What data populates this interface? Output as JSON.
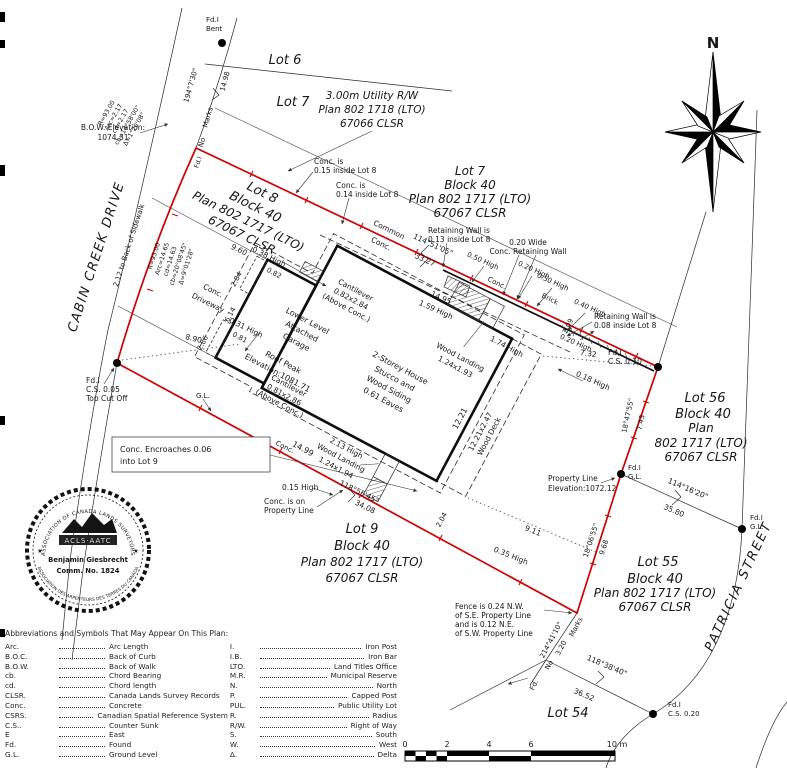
{
  "colors": {
    "boundary": "#d10000",
    "ink": "#161616"
  },
  "compass": {
    "north": "N"
  },
  "labels": {
    "fdi_bent_1": "Fd.I",
    "fdi_bent_2": "Bent",
    "lot6": "Lot 6",
    "lot7_nw": "Lot 7",
    "utility_rw_1": "3.00m Utility R/W",
    "utility_rw_2": "Plan 802 1718 (LTO)",
    "utility_rw_3": "67066 CLSR",
    "brg_street_n": "194°7'30\"",
    "dist_street_n": "14.98",
    "marks_top": "Marks",
    "no_top": "No",
    "fdi_p1": "Fd.I",
    "curve1_r": "R=93.00",
    "curve1_arc": "Arc=2.17",
    "curve1_cd": "cd=2.17",
    "curve1_cb": "cb=14°58'00\"",
    "curve1_d": "Δ=1°20'08\"",
    "bow_1": "B.O.W. Elevation:",
    "bow_2": "1074.31",
    "cabin_creek": "CABIN CREEK DRIVE",
    "sidewalk_tie": "2.12 to Back of Sidewalk",
    "curve2_r": "R=93.00",
    "curve2_arc": "Arc=14.65",
    "curve2_cd": "cd=14.63",
    "curve2_cb": "cb=20°08'45\"",
    "curve2_d": "Δ=9°01'28\"",
    "lot8_1": "Lot 8",
    "lot8_2": "Block 40",
    "lot8_3": "Plan 802 1717 (LTO)",
    "lot8_4": "67067 CLSR",
    "conc015_1": "Conc. is",
    "conc015_2": "0.15 inside Lot 8",
    "conc014_1": "Conc. is",
    "conc014_2": "0.14 inside Lot 8",
    "common_1": "Common",
    "common_2": "Conc.",
    "brg_north": "114°51'05\"",
    "dist_north": "33.27",
    "dim_960": "9.60",
    "h_038": "0.38 High",
    "conc_drive_1": "Conc.",
    "conc_drive_2": "Driveway",
    "h_031": "0.31 High",
    "dim_890": "8.90",
    "gl_south": "G.L.",
    "fdi_p5_1": "Fd.I",
    "fdi_p5_2": "C.S. 0.05",
    "fdi_p5_3": "Top Cut Off",
    "encroach_1": "Conc. Encroaches 0.06",
    "encroach_2": "into Lot 9",
    "lot7_1": "Lot 7",
    "lot7_2": "Block 40",
    "lot7_3": "Plan 802 1717 (LTO)",
    "lot7_4": "67067 CLSR",
    "rw1_1": "Retaining Wall is",
    "rw1_2": "0.13 inside Lot 8",
    "rww_1": "0.20 Wide",
    "rww_2": "Conc. Retaining Wall",
    "h_050a": "0.50 High",
    "h_020a": "0.20 High",
    "h_050b": "0.50 High",
    "brick": "Brick",
    "h_040": "0.40 High",
    "rw2_1": "Retaining Wall is",
    "rw2_2": "0.08 inside Lot 8",
    "dim_1495": "14.95",
    "h_159": "1.59 High",
    "dim_209": "2.09",
    "h_020b": "0.20 High",
    "dim_732": "7.32",
    "h_018": "0.18 High",
    "conc_wall": "Conc.",
    "cant1_1": "Cantilever",
    "cant1_2": "0.82x2.84",
    "cant1_3": "(Above Conc.)",
    "cant2_1": "Cantilever",
    "cant2_2": "0.81x2.86",
    "cant2_3": "(Above Conc.)",
    "garage_1": "Lower Level",
    "garage_2": "Attached",
    "garage_3": "Garage",
    "roof_1": "Roof Peak",
    "roof_2": "Elevation:1081.71",
    "house_1": "2-Storey House",
    "house_2": "Stucco and",
    "house_3": "Wood Siding",
    "house_4": "0.61 Eaves",
    "dim_082": "0.82",
    "dim_284": "2.84",
    "dim_081": "0.81",
    "dim_286": "2.86",
    "dim_614": "6.14",
    "wl_n_1": "Wood Landing",
    "wl_n_2": "1.24x1.93",
    "h_174": "1.74 High",
    "dim_1221": "12.21",
    "deck_1": "12.21x2.47",
    "deck_2": "Wood Deck",
    "wl_s_1": "2.13 High",
    "wl_s_2": "Wood Landing",
    "wl_s_3": "1.24x1.94",
    "dim_1499": "14.99",
    "dim_204": "2.04",
    "h_015": "0.15 High",
    "concpl_1": "Conc. is on",
    "concpl_2": "Property Line",
    "brg_south": "118°55'45\"",
    "dist_south": "34.08",
    "lot9_1": "Lot 9",
    "lot9_2": "Block 40",
    "lot9_3": "Plan 802 1717 (LTO)",
    "lot9_4": "67067 CLSR",
    "dim_911": "9.11",
    "h_035": "0.35 High",
    "conc_s": "Conc.",
    "fdi_p2_1": "Fd.I",
    "fdi_p2_2": "C.S. 0.10",
    "brg_e1": "18°47'55\"",
    "dist_e1": "7.43",
    "lot56_1": "Lot 56",
    "lot56_2": "Block 40",
    "lot56_3": "Plan",
    "lot56_4": "802 1717 (LTO)",
    "lot56_5": "67067 CLSR",
    "pl_elev_1": "Property Line",
    "pl_elev_2": "Elevation:1072.12",
    "fdi_p3_1": "Fd.I",
    "fdi_p3_2": "G.L.",
    "brg_5680": "114°16'20\"",
    "dist_3580": "35.80",
    "fdi_56_1": "Fd.I",
    "fdi_56_2": "G.L.",
    "brg_e2": "18°06'55\"",
    "dist_e2": "9.68",
    "lot55_1": "Lot 55",
    "lot55_2": "Block 40",
    "lot55_3": "Plan 802 1717 (LTO)",
    "lot55_4": "67067 CLSR",
    "fence_1": "Fence is 0.24 N.W.",
    "fence_2": "of S.E. Property Line",
    "fence_3": "and is 0.12 N.E.",
    "fence_4": "of S.W. Property Line",
    "brg_sw": "214°41'10\"",
    "dist_320": "3.20",
    "marks_sw": "Marks",
    "no_sw": "No",
    "fd_sw": "Fd.",
    "brg_54": "118°38'40\"",
    "dist_3652": "36.52",
    "lot54": "Lot 54",
    "fdi_54_1": "Fd.I",
    "fdi_54_2": "C.S. 0.20",
    "patricia": "PATRICIA STREET"
  },
  "stamp": {
    "ring_top": "ASSOCIATION OF CANADA LANDS SURVEYORS",
    "ring_bottom": "ASSOCIATION DES ARPENTEURS DES TERRES DU CANADA",
    "star_left": "★",
    "star_right": "★",
    "org": "ACLS·AATC",
    "name": "Benjamin Giesbrecht",
    "commission": "Comm. No. 1824"
  },
  "scale_bar": {
    "t0": "0",
    "t2": "2",
    "t4": "4",
    "t6": "6",
    "end": "10 m"
  },
  "abbreviations": {
    "title": "Abbreviations and Symbols That May Appear On This Plan:",
    "left": [
      {
        "a": "Arc.",
        "d": "Arc Length"
      },
      {
        "a": "B.O.C.",
        "d": "Back of Curb"
      },
      {
        "a": "B.O.W.",
        "d": "Back of Walk"
      },
      {
        "a": "cb.",
        "d": "Chord Bearing"
      },
      {
        "a": "cd.",
        "d": "Chord length"
      },
      {
        "a": "CLSR.",
        "d": "Canada Lands Survey Records"
      },
      {
        "a": "Conc.",
        "d": "Concrete"
      },
      {
        "a": "CSRS.",
        "d": "Canadian Spatial Reference System"
      },
      {
        "a": "C.S..",
        "d": "Counter Sunk"
      },
      {
        "a": "E",
        "d": "East"
      },
      {
        "a": "Fd.",
        "d": "Found"
      },
      {
        "a": "G.L.",
        "d": "Ground Level"
      }
    ],
    "right": [
      {
        "a": "I.",
        "d": "Iron Post"
      },
      {
        "a": "I.B.",
        "d": "Iron Bar"
      },
      {
        "a": "LTO.",
        "d": "Land Titles Office"
      },
      {
        "a": "M.R.",
        "d": "Municipal Reserve"
      },
      {
        "a": "N.",
        "d": "North"
      },
      {
        "a": "P.",
        "d": "Capped Post"
      },
      {
        "a": "PUL.",
        "d": "Public Utility Lot"
      },
      {
        "a": "R.",
        "d": "Radius"
      },
      {
        "a": "R/W.",
        "d": "Right of Way"
      },
      {
        "a": "S.",
        "d": "South"
      },
      {
        "a": "W.",
        "d": "West"
      },
      {
        "a": "Δ.",
        "d": "Delta"
      }
    ]
  }
}
